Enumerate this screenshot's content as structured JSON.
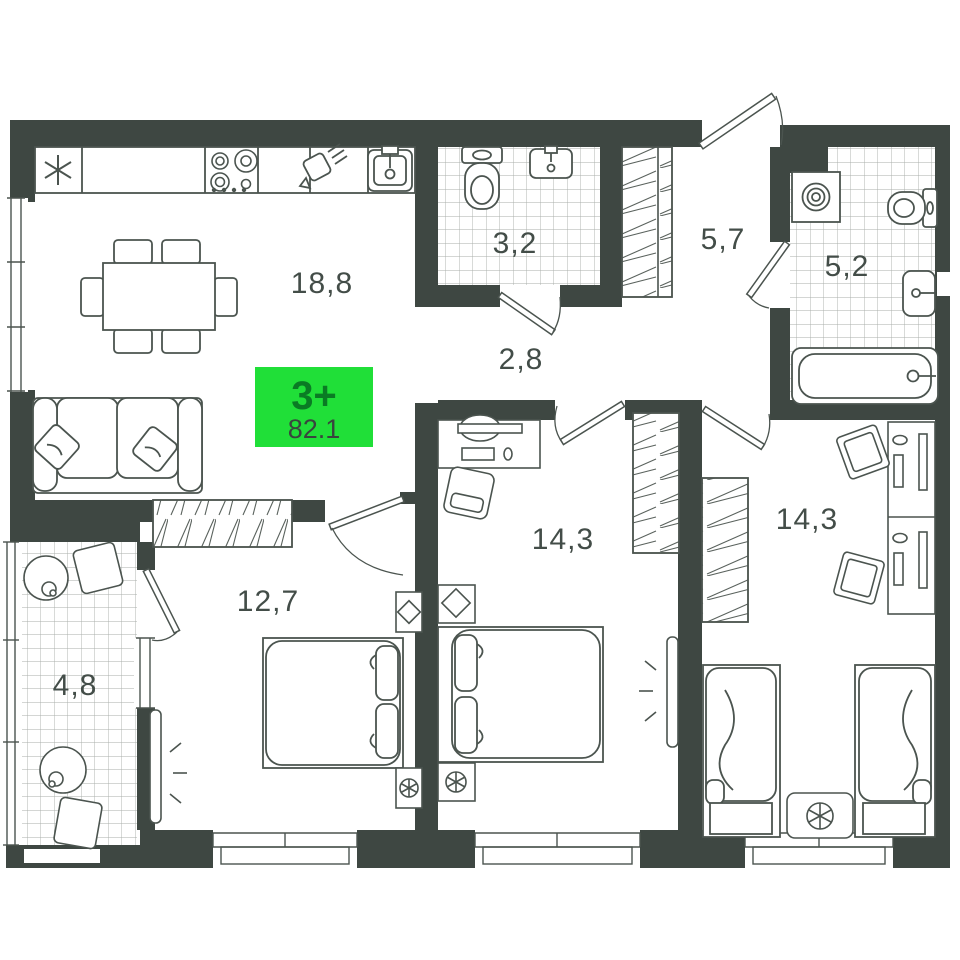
{
  "plan": {
    "badge": {
      "rooms_label": "3+",
      "total_area": "82.1",
      "color": "#20df38"
    },
    "rooms": [
      {
        "id": "kitchen-living",
        "area": "18,8"
      },
      {
        "id": "bathroom-small",
        "area": "3,2"
      },
      {
        "id": "hallway-entry",
        "area": "5,7"
      },
      {
        "id": "bathroom-large",
        "area": "5,2"
      },
      {
        "id": "corridor",
        "area": "2,8"
      },
      {
        "id": "bedroom-middle",
        "area": "14,3"
      },
      {
        "id": "children-room",
        "area": "14,3"
      },
      {
        "id": "bedroom-left",
        "area": "12,7"
      },
      {
        "id": "balcony",
        "area": "4,8"
      }
    ],
    "colors": {
      "wall": "#3e4742",
      "line": "#4b544f",
      "label": "#434d48"
    }
  }
}
